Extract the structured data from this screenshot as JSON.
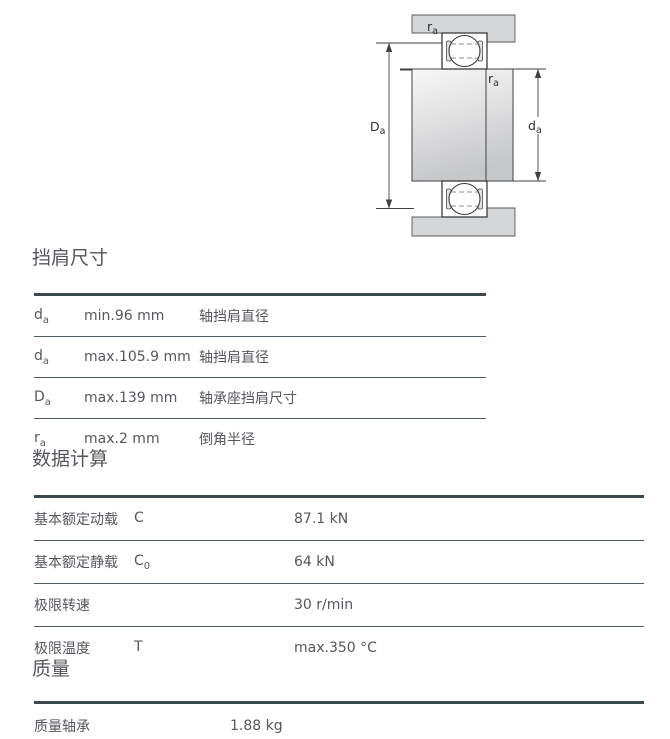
{
  "diagram": {
    "label_ra_top": {
      "base": "r",
      "sub": "a"
    },
    "label_ra_mid": {
      "base": "r",
      "sub": "a"
    },
    "label_Da": {
      "base": "D",
      "sub": "a"
    },
    "label_da": {
      "base": "d",
      "sub": "a"
    }
  },
  "shoulder_section": {
    "title": "挡肩尺寸",
    "rows": [
      {
        "symbol": "d",
        "sub": "a",
        "value": "min.96 mm",
        "desc": "轴挡肩直径"
      },
      {
        "symbol": "d",
        "sub": "a",
        "value": "max.105.9 mm",
        "desc": "轴挡肩直径"
      },
      {
        "symbol": "D",
        "sub": "a",
        "value": "max.139 mm",
        "desc": "轴承座挡肩尺寸"
      },
      {
        "symbol": "r",
        "sub": "a",
        "value": "max.2 mm",
        "desc": "倒角半径"
      }
    ]
  },
  "calculation_section": {
    "title": "数据计算",
    "rows": [
      {
        "label": "基本额定动载",
        "symbol": "C",
        "sub": "",
        "value": "87.1 kN"
      },
      {
        "label": "基本额定静载",
        "symbol": "C",
        "sub": "0",
        "value": "64 kN"
      },
      {
        "label": "极限转速",
        "symbol": "",
        "sub": "",
        "value": "30 r/min"
      },
      {
        "label": "极限温度",
        "symbol": "T",
        "sub": "",
        "value": "max.350 °C"
      }
    ]
  },
  "mass_section": {
    "title": "质量",
    "rows": [
      {
        "label": "质量轴承",
        "value": "1.88 kg"
      }
    ]
  }
}
